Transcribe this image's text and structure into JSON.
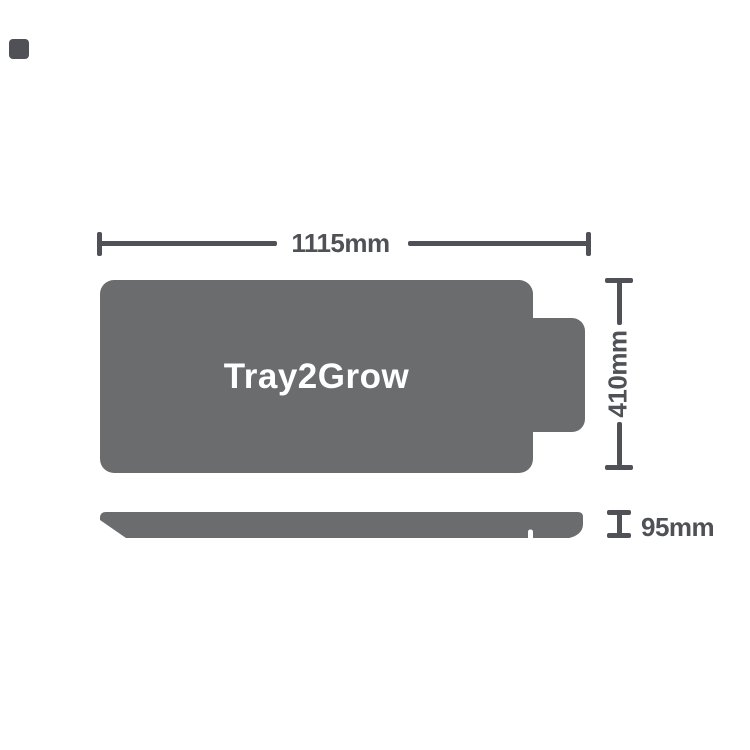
{
  "diagram": {
    "title": "Tray2Grow",
    "dim_width": "1115mm",
    "dim_height": "410mm",
    "dim_depth": "95mm"
  },
  "colors": {
    "background": "#ffffff",
    "tray": "#6b6c6e",
    "dimension": "#4f5156",
    "title_text": "#ffffff"
  }
}
